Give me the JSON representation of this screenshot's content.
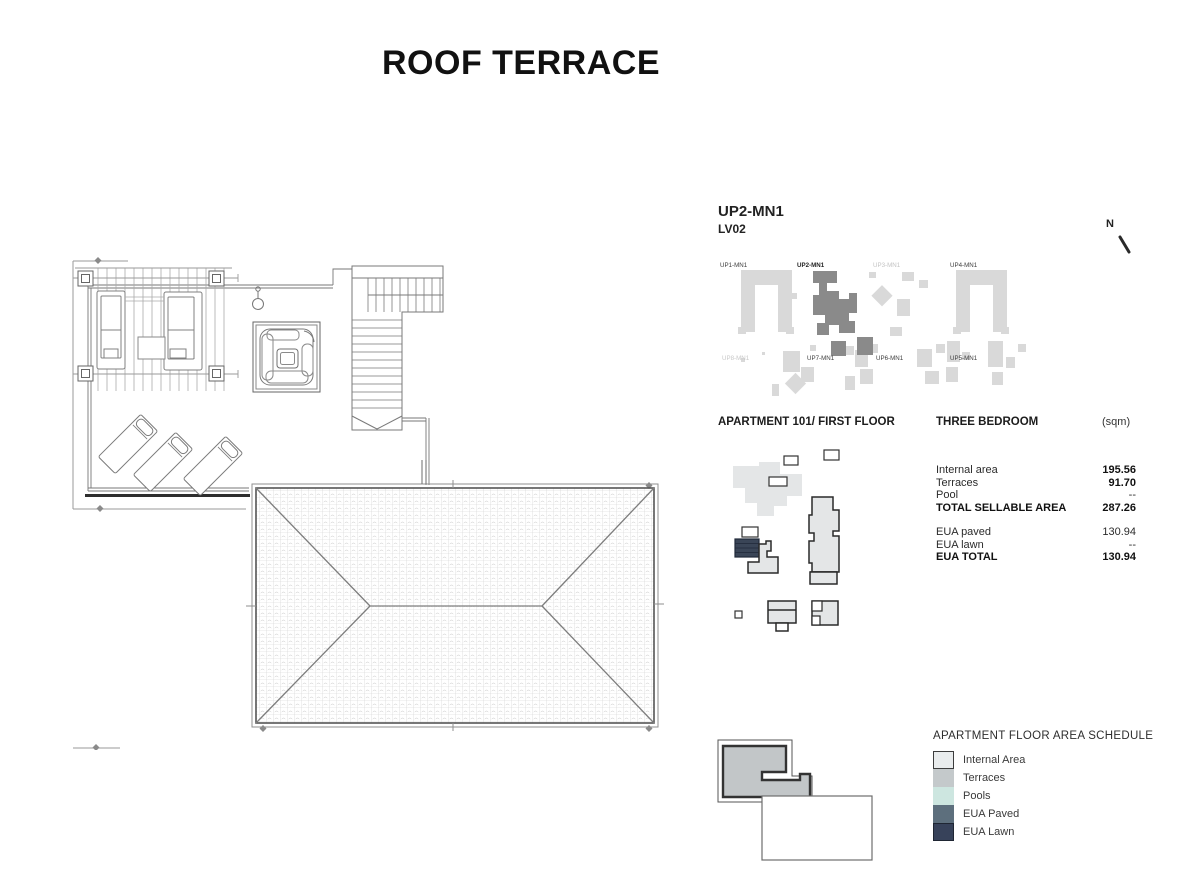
{
  "page": {
    "title": "ROOF TERRACE"
  },
  "header": {
    "unit_code": "UP2-MN1",
    "level_code": "LV02"
  },
  "north_indicator": {
    "label": "N"
  },
  "site_plan": {
    "base_color": "#d9d9d9",
    "highlight_color": "#8a8a8a",
    "units": [
      {
        "label": "UP1-MN1",
        "state": "normal"
      },
      {
        "label": "UP2-MN1",
        "state": "highlighted"
      },
      {
        "label": "UP3-MN1",
        "state": "dimmed"
      },
      {
        "label": "UP4-MN1",
        "state": "normal"
      },
      {
        "label": "UP8-MN1",
        "state": "dimmed"
      },
      {
        "label": "UP7-MN1",
        "state": "normal"
      },
      {
        "label": "UP6-MN1",
        "state": "normal"
      },
      {
        "label": "UP5-MN1",
        "state": "normal"
      }
    ]
  },
  "apartment": {
    "title": "APARTMENT 101/ FIRST FLOOR",
    "bedroom_type": "THREE BEDROOM",
    "unit_suffix": "(sqm)",
    "areas": [
      {
        "label": "Internal area",
        "value": "195.56"
      },
      {
        "label": "Terraces",
        "value": "91.70"
      },
      {
        "label": "Pool",
        "value": "--"
      },
      {
        "label": "TOTAL SELLABLE AREA",
        "value": "287.26"
      },
      {
        "label": "EUA paved",
        "value": "130.94"
      },
      {
        "label": "EUA lawn",
        "value": "--"
      },
      {
        "label": "EUA TOTAL",
        "value": "130.94"
      }
    ]
  },
  "legend": {
    "title": "APARTMENT FLOOR AREA SCHEDULE",
    "items": [
      {
        "label": "Internal Area",
        "color": "#e9eced"
      },
      {
        "label": "Terraces",
        "color": "#c4c9cb"
      },
      {
        "label": "Pools",
        "color": "#cde6e0"
      },
      {
        "label": "EUA Paved",
        "color": "#5d6f7d"
      },
      {
        "label": "EUA Lawn",
        "color": "#37425a"
      }
    ]
  }
}
